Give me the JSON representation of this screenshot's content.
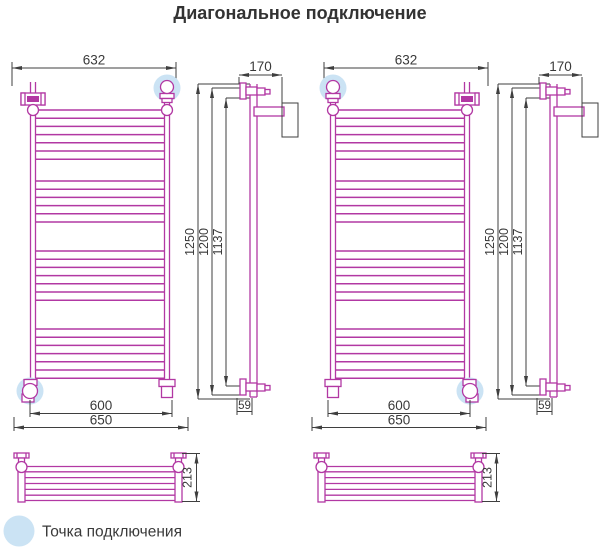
{
  "title": "Диагональное подключение",
  "legend": {
    "label": "Точка подключения"
  },
  "colors": {
    "pipe": "#b238a3",
    "dimension": "#3f3f3f",
    "highlight": "#cbe3f4",
    "text": "#3a3a3a"
  },
  "dimensions": {
    "top_width": "632",
    "rail_spacing": "600",
    "bracket_span": "650",
    "wall_offset": "170",
    "height_overall": "1250",
    "height_rail": "1200",
    "height_mount": "1137",
    "bottom_offset": "59",
    "shelf_depth": "213"
  },
  "front_view": {
    "rung_groups": [
      {
        "start_y": 110,
        "count": 7
      },
      {
        "start_y": 181,
        "count": 6
      },
      {
        "start_y": 251,
        "count": 7
      },
      {
        "start_y": 329,
        "count": 7
      }
    ],
    "rung_spacing": 8.2
  },
  "bottom_view": {
    "slat_count": 5
  },
  "diagrams": [
    {
      "id": "left",
      "connection_points": [
        "top-right",
        "bottom-left"
      ]
    },
    {
      "id": "right",
      "connection_points": [
        "top-left",
        "bottom-right"
      ]
    }
  ]
}
